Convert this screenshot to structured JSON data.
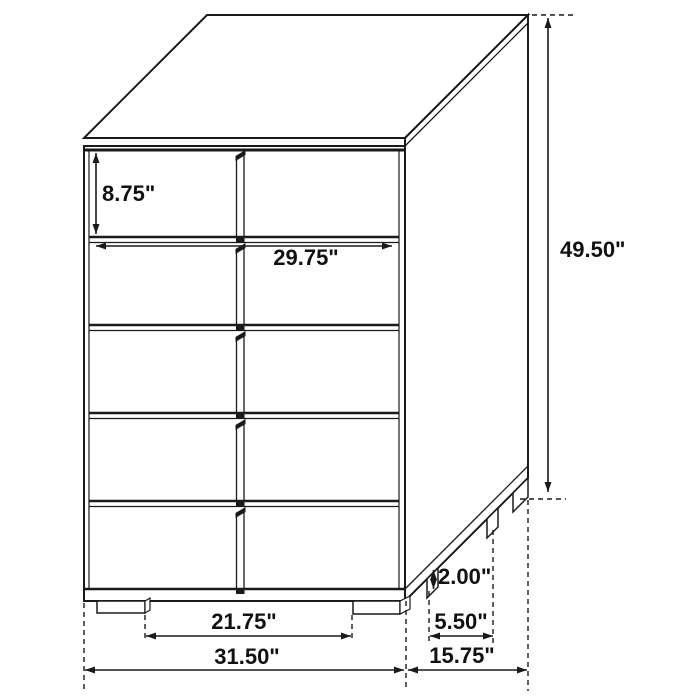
{
  "diagram": {
    "subject": "five-drawer-chest-dimension-drawing",
    "drawer_count": 5,
    "colors": {
      "line": "#1a1a1a",
      "background": "#ffffff",
      "text": "#111111"
    },
    "dimensions": {
      "top_drawer_height": "8.75\"",
      "drawer_front_width": "29.75\"",
      "overall_height": "49.50\"",
      "foot_height": "2.00\"",
      "side_foot_spacing": "5.50\"",
      "front_foot_spacing": "21.75\"",
      "overall_width": "31.50\"",
      "overall_depth": "15.75\""
    }
  }
}
